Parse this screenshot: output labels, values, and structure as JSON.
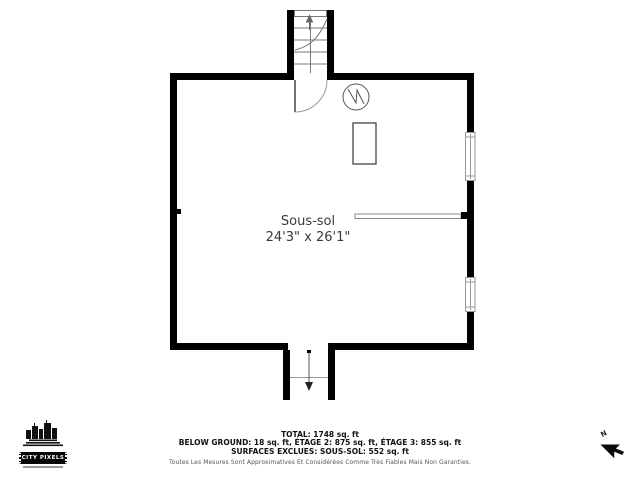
{
  "plan": {
    "room": {
      "label": "Sous-sol",
      "dimensions": "24'3\" x 26'1\""
    },
    "icons": [
      "staircase-up",
      "stair-up-arrow",
      "entry-door-swing",
      "electrical-panel",
      "appliance-box",
      "half-wall-railing",
      "window-upper",
      "window-lower",
      "exterior-entry",
      "exit-down-arrow",
      "north-arrow",
      "city-pixels-logo"
    ]
  },
  "summary": {
    "total": "TOTAL: 1748 sq. ft",
    "floors": "BELOW GROUND: 18 sq. ft, ÉTAGE 2: 875 sq. ft, ÉTAGE 3: 855 sq. ft",
    "exclusions": "SURFACES EXCLUES: SOUS-SOL: 552 sq. ft",
    "disclaimer": "Toutes Les Mesures Sont Approximatives Et Considérées Comme Très Fiables Mais Non Garanties."
  },
  "branding": {
    "logo_text": "CITY PIXELS"
  },
  "compass": {
    "north_label": "N"
  },
  "colors": {
    "wall": "#000000",
    "thin_line": "#8a8a8a",
    "text_primary": "#3a3a3a",
    "background": "#ffffff"
  }
}
